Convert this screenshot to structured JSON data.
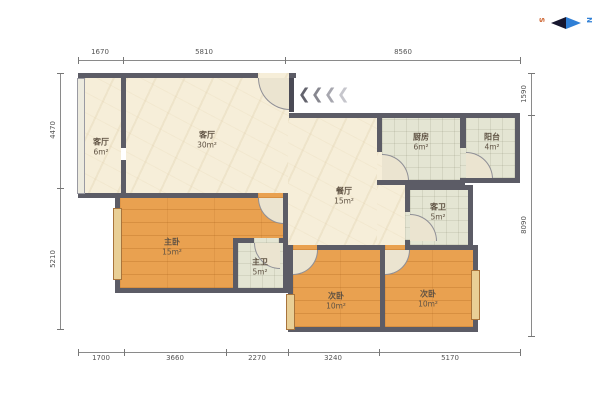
{
  "compass": {
    "south": "S",
    "north": "N"
  },
  "entrance": {
    "arrow_glyph": "❮"
  },
  "rooms": [
    {
      "id": "hall-small",
      "name": "客厅",
      "area": "6m²"
    },
    {
      "id": "living",
      "name": "客厅",
      "area": "30m²"
    },
    {
      "id": "dining",
      "name": "餐厅",
      "area": "15m²"
    },
    {
      "id": "kitchen",
      "name": "厨房",
      "area": "6m²"
    },
    {
      "id": "balcony",
      "name": "阳台",
      "area": "4m²"
    },
    {
      "id": "guest-bath",
      "name": "客卫",
      "area": "5m²"
    },
    {
      "id": "master-bedroom",
      "name": "主卧",
      "area": "15m²"
    },
    {
      "id": "master-bath",
      "name": "主卫",
      "area": "5m²"
    },
    {
      "id": "bedroom2",
      "name": "次卧",
      "area": "10m²"
    },
    {
      "id": "bedroom3",
      "name": "次卧",
      "area": "10m²"
    }
  ],
  "dimensions": {
    "top": [
      "1670",
      "5810",
      "8560"
    ],
    "bottom": [
      "1700",
      "3660",
      "2270",
      "3240",
      "5170"
    ],
    "left": [
      "4470",
      "5210"
    ],
    "right": [
      "1590",
      "8090"
    ]
  },
  "colors": {
    "wall": "#5c5c66",
    "floor_living": "#f6eed9",
    "floor_wood": "#e9a150",
    "floor_tile": "#e4e5d3",
    "compass_north": "#2f7fd6",
    "compass_south": "#cc5f2a"
  }
}
